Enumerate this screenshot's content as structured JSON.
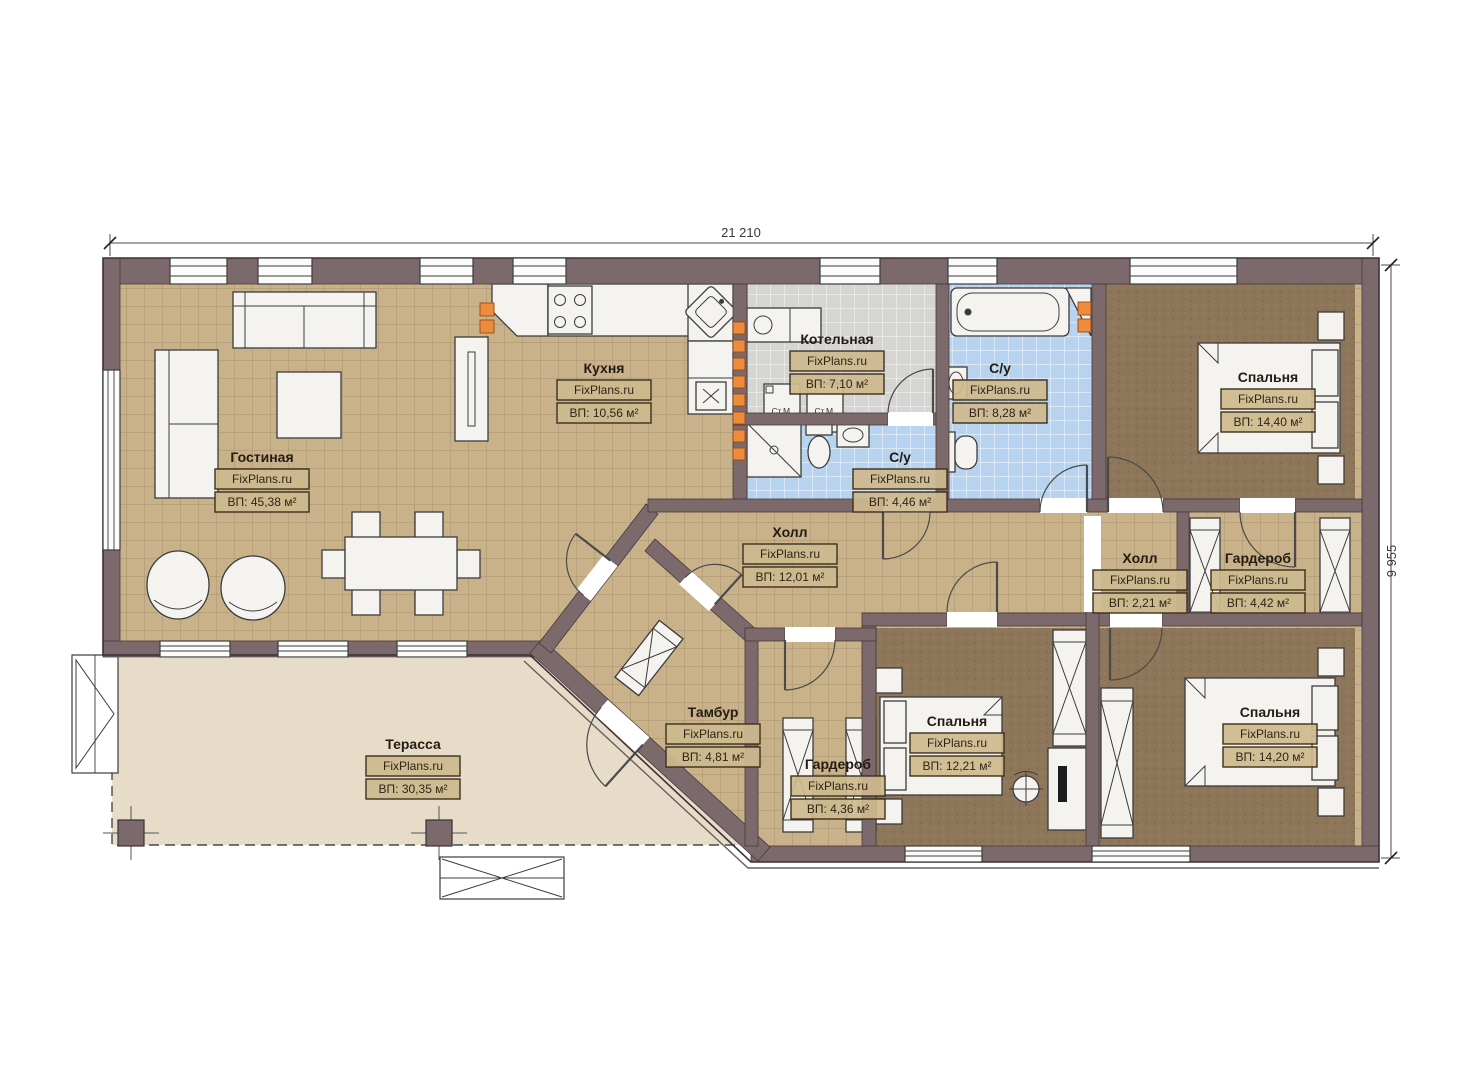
{
  "watermark": "FixPlans.ru",
  "dimensions": {
    "width_label": "21 210",
    "height_label": "9 955"
  },
  "rooms": {
    "living": {
      "name": "Гостиная",
      "area": "ВП: 45,38 м²"
    },
    "kitchen": {
      "name": "Кухня",
      "area": "ВП: 10,56 м²"
    },
    "boiler": {
      "name": "Котельная",
      "area": "ВП: 7,10 м²"
    },
    "bath_small": {
      "name": "С/у",
      "area": "ВП: 4,46 м²"
    },
    "bath_big": {
      "name": "С/у",
      "area": "ВП: 8,28 м²"
    },
    "hall_main": {
      "name": "Холл",
      "area": "ВП: 12,01 м²"
    },
    "hall_small": {
      "name": "Холл",
      "area": "ВП: 2,21 м²"
    },
    "wardrobe_right": {
      "name": "Гардероб",
      "area": "ВП: 4,42 м²"
    },
    "wardrobe_bottom": {
      "name": "Гардероб",
      "area": "ВП: 4,36 м²"
    },
    "tambour": {
      "name": "Тамбур",
      "area": "ВП: 4,81 м²"
    },
    "bedroom_top_right": {
      "name": "Спальня",
      "area": "ВП: 14,40 м²"
    },
    "bedroom_bottom_middle": {
      "name": "Спальня",
      "area": "ВП: 12,21 м²"
    },
    "bedroom_bottom_right": {
      "name": "Спальня",
      "area": "ВП: 14,20 м²"
    },
    "terrace": {
      "name": "Терасса",
      "area": "ВП: 30,35 м²"
    }
  },
  "appliances": {
    "washing_machine_1": "Ст.М.",
    "washing_machine_2": "Ст.М."
  },
  "colors": {
    "wall": "#7c696c",
    "tile_floor": "#c9b28a",
    "bedroom_floor": "#8d7659",
    "bath_tile": "#b7d3ef",
    "utility_tile": "#d6d5d3",
    "terrace_floor": "#e7dcc8",
    "accent_orange": "#ee8c3e",
    "label_box": "#cdb78e"
  }
}
